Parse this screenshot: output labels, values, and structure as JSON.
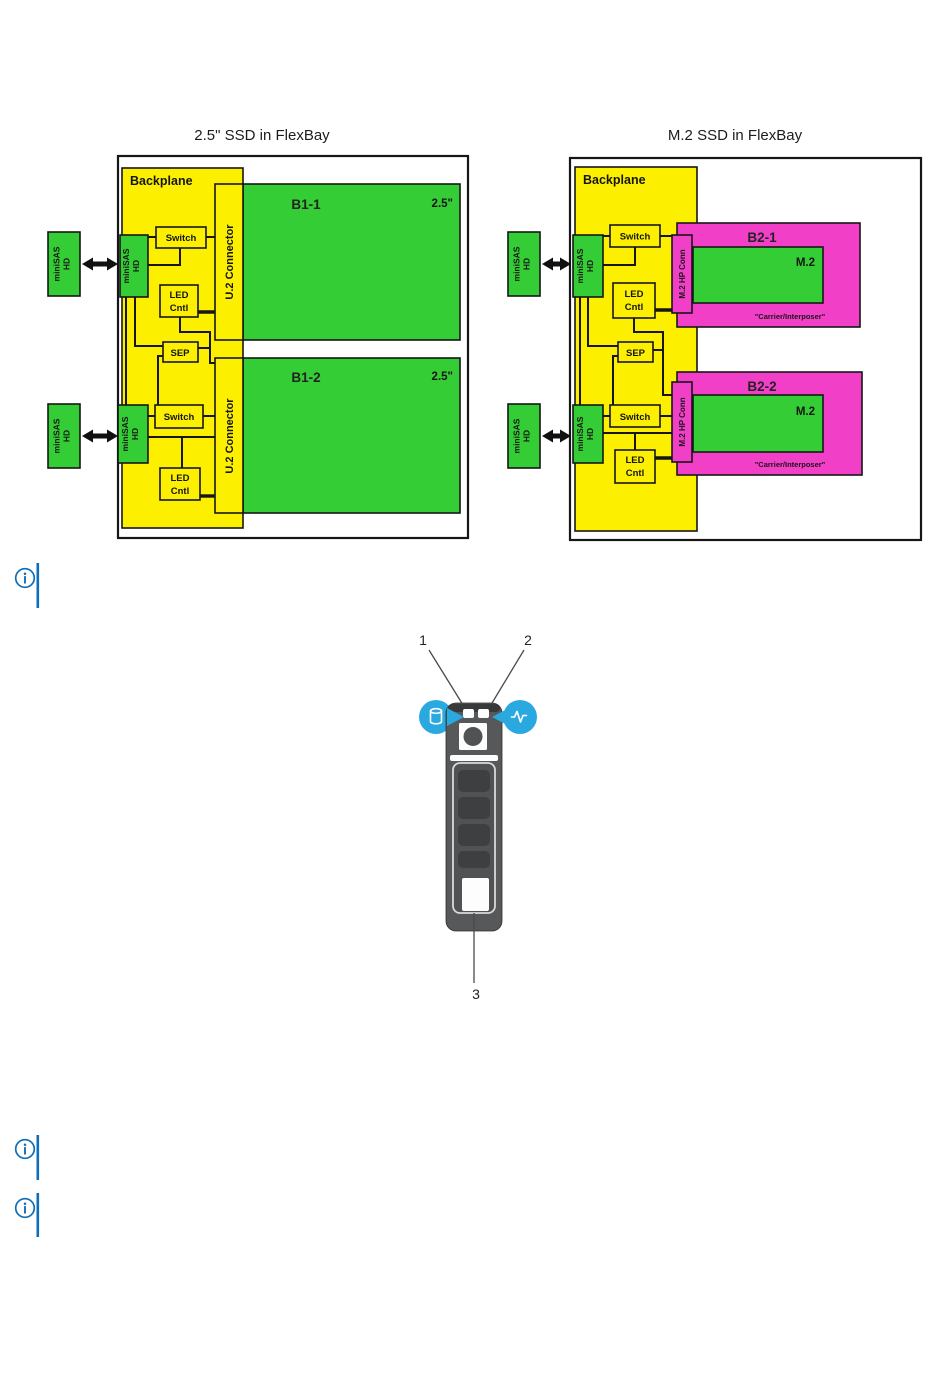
{
  "figures": {
    "flexbay_25": {
      "title": "2.5\" SSD in FlexBay",
      "backplane": "Backplane",
      "connector": "U.2 Connector",
      "bays": [
        {
          "name": "B1-1",
          "size": "2.5\""
        },
        {
          "name": "B1-2",
          "size": "2.5\""
        }
      ]
    },
    "flexbay_m2": {
      "title": "M.2 SSD in FlexBay",
      "backplane": "Backplane",
      "connector": "M.2 HP Conn",
      "bays": [
        {
          "name": "B2-1",
          "module": "M.2",
          "carrier": "\"Carrier/Interposer\""
        },
        {
          "name": "B2-2",
          "module": "M.2",
          "carrier": "\"Carrier/Interposer\""
        }
      ]
    },
    "shared_labels": {
      "switch": "Switch",
      "sep": "SEP",
      "led_line1": "LED",
      "led_line2": "Cntl",
      "minisas_line1": "miniSAS",
      "minisas_line2": "HD"
    },
    "drive_carrier": {
      "callouts": [
        "1",
        "2",
        "3"
      ],
      "icons": {
        "left": "hard-drive-status-icon",
        "right": "drive-activity-icon"
      }
    }
  },
  "notes": [
    {
      "icon": "info-icon"
    },
    {
      "icon": "info-icon"
    },
    {
      "icon": "info-icon"
    }
  ],
  "colors": {
    "backplane-yellow": "#fcf000",
    "block-green": "#35cd35",
    "carrier-magenta": "#f23fc8",
    "note-blue": "#0e6eb8",
    "callout-blue": "#2aa9e0",
    "carrier-gray": "#57585a",
    "carrier-dark": "#3e3f41"
  }
}
